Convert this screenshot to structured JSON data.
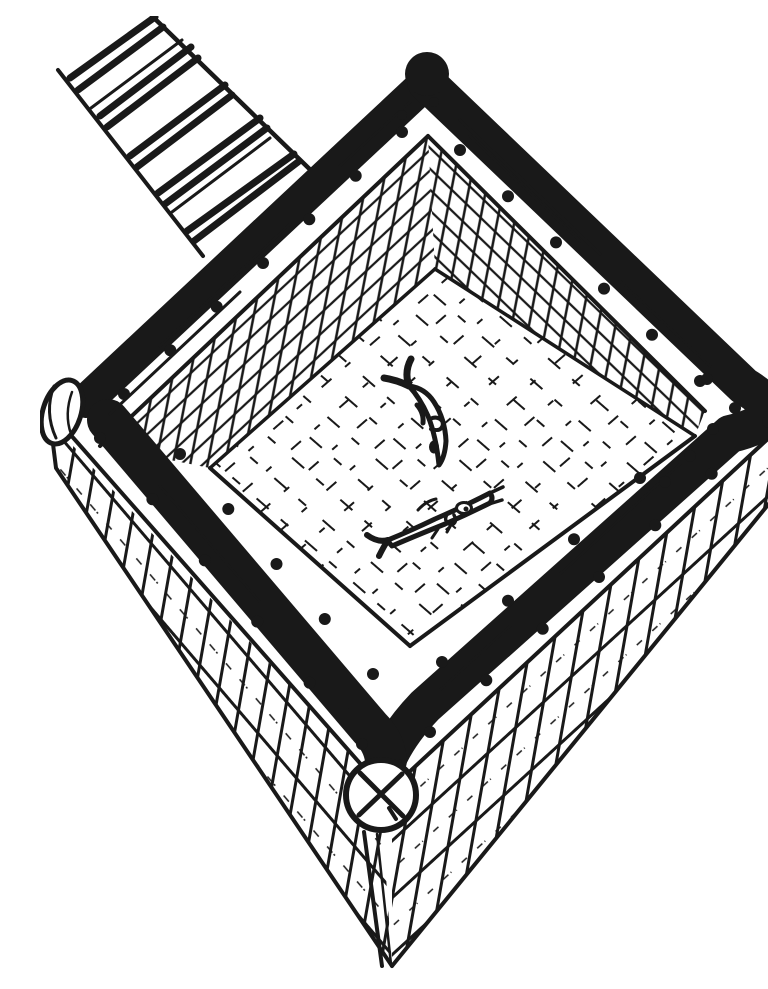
{
  "meta": {
    "title": "Hand-drawn fish cage illustration",
    "medium": "pen-and-ink sketch, black on white",
    "background_color": "#ffffff",
    "ink_color": "#191919"
  },
  "scene": {
    "description": "A floating square fish cage (net pen) built from logs, viewed from above at an angle. A plank walkway with cross slats leads to the upper-left side of the rim. The rim is made of dark logs with white plank walers fastened by round bolts. Cross-hatched netting covers the outer walls, finer mesh netting lines the inner walls and floor, and two fish swim inside the cage.",
    "walkway": {
      "label": "plank walkway with cross slats"
    },
    "rim": {
      "label": "square log rim with bolted plank walers"
    },
    "exterior_walls": {
      "label": "outer walls of cross-hatched netting"
    },
    "interior_walls": {
      "label": "inner walls of fine mesh netting"
    },
    "floor": {
      "label": "net floor of the cage"
    },
    "log_ends": {
      "left": "round log end at left corner",
      "bottom": "round log end with X cut at bottom corner",
      "right": "dark rounded log end at right corner"
    },
    "fish": [
      {
        "label": "fish swimming head-down toward the lower right"
      },
      {
        "label": "fish swimming toward the upper right with open mouth"
      }
    ],
    "fish_count": 2
  }
}
